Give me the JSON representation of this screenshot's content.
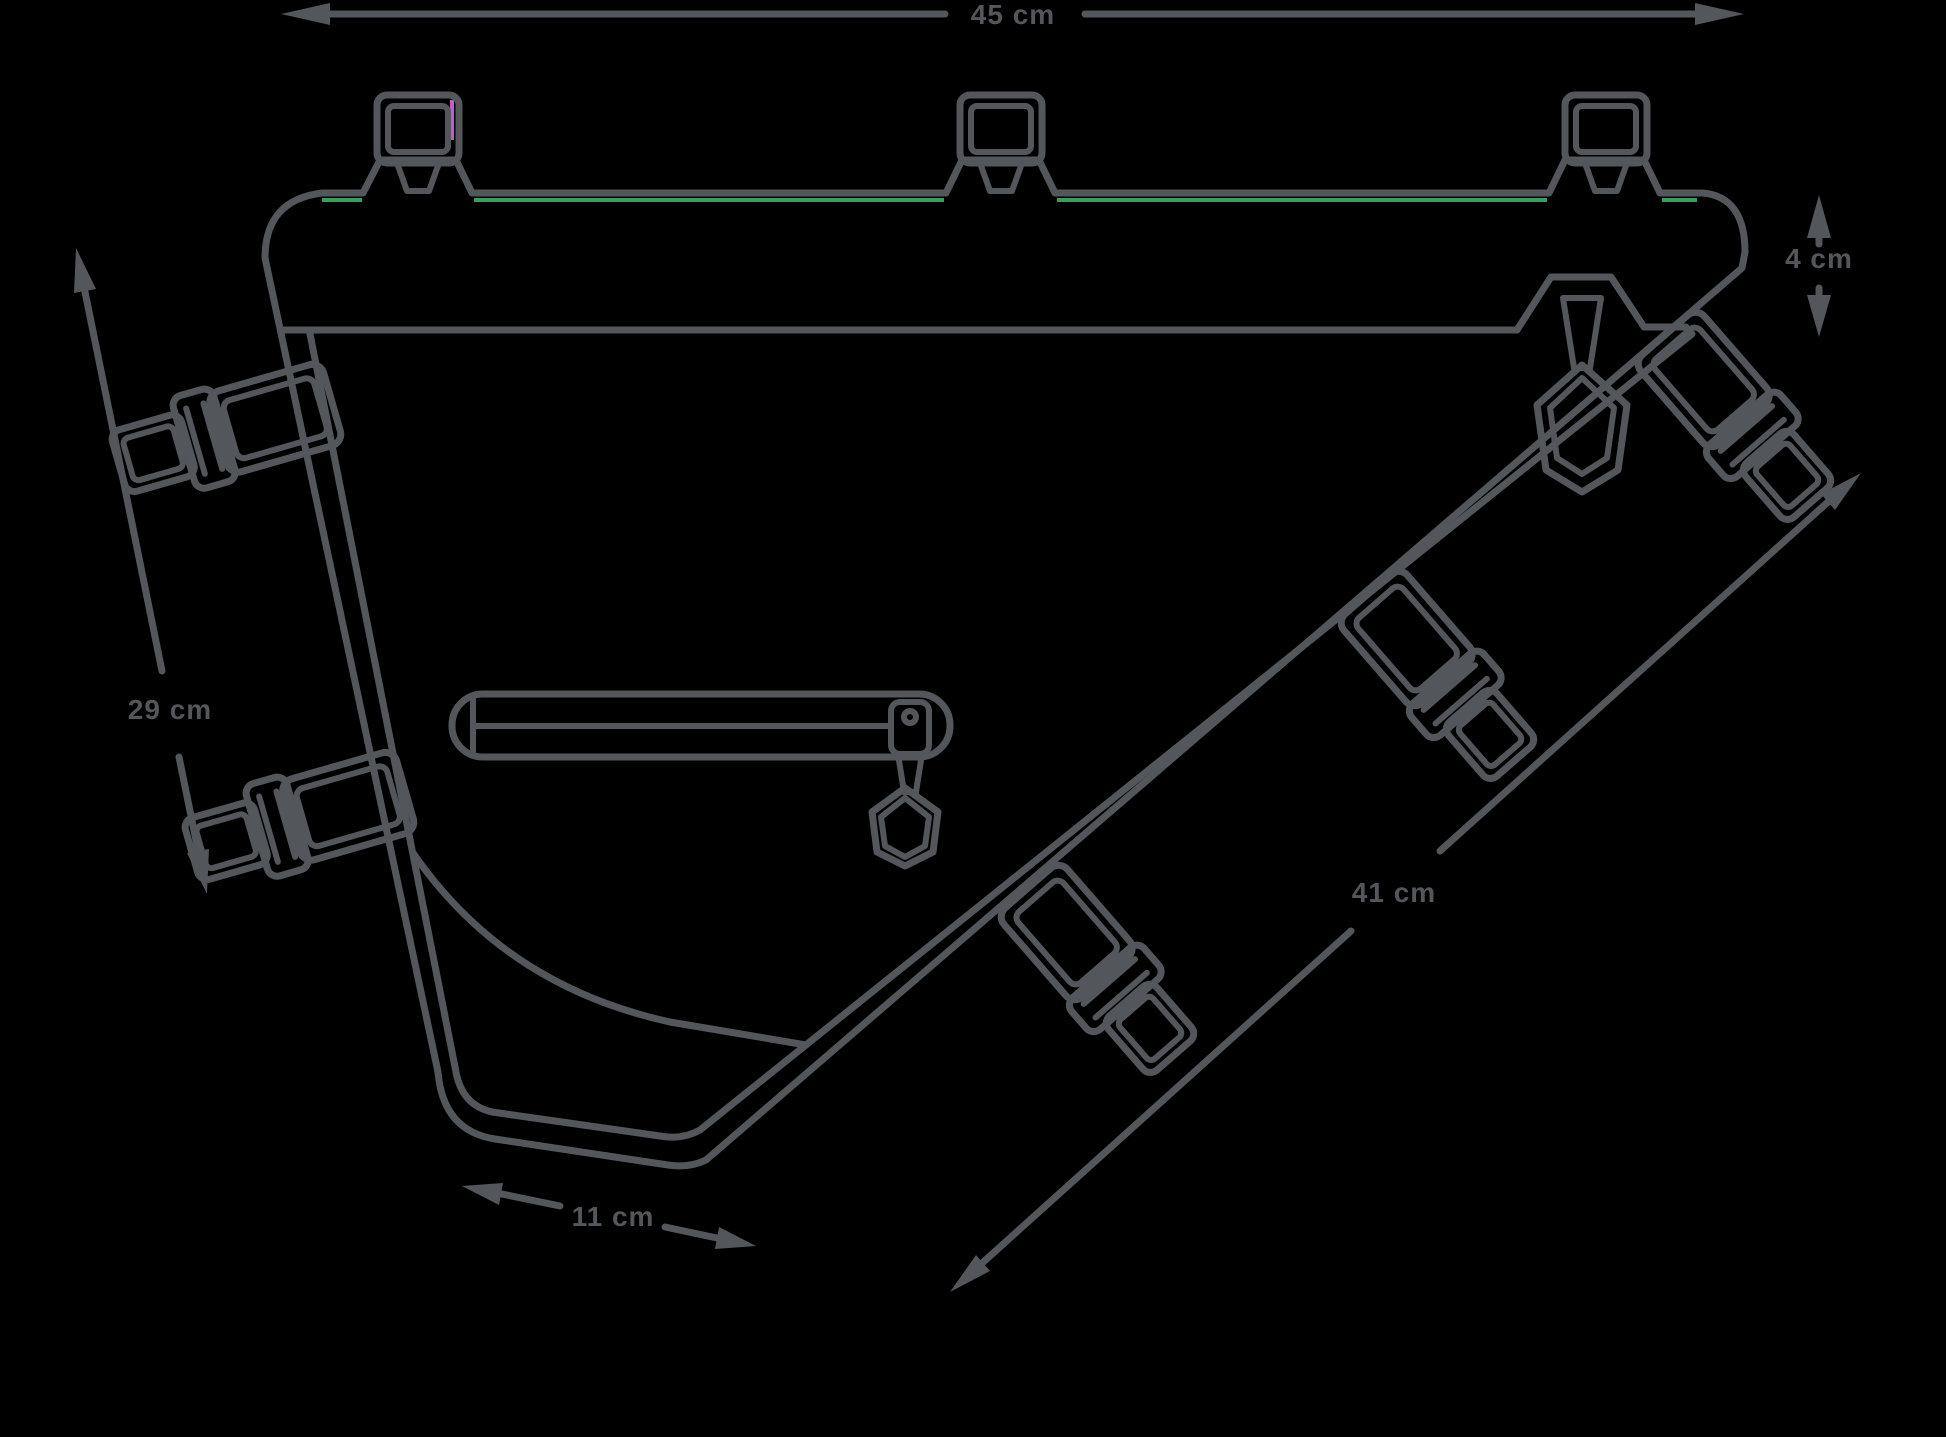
{
  "page": {
    "background": "#000000",
    "description_colors": {
      "line": "#53565A",
      "text": "#53565A",
      "accent_green": "#34A05E",
      "accent_magenta": "#C75BC7"
    }
  },
  "dimensions": {
    "top_width": "45 cm",
    "bar_height": "4 cm",
    "left_height": "29 cm",
    "diagonal_length": "41 cm",
    "bottom_width": "11 cm"
  }
}
